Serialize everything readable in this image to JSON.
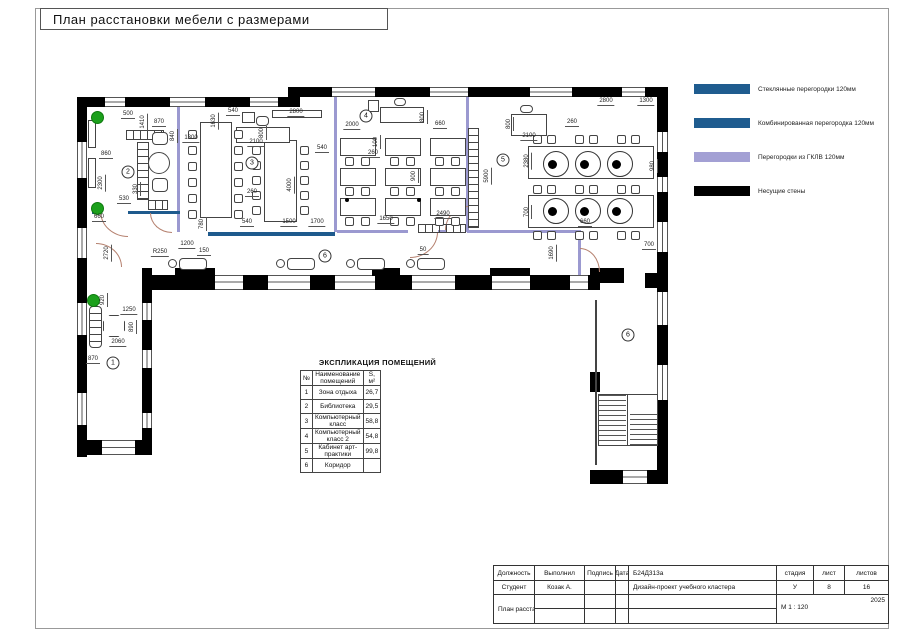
{
  "sheet": {
    "title": "План расстановки мебели с размерами"
  },
  "legend": {
    "items": [
      {
        "name": "glass-partition",
        "label": "Стеклянные перегородки  120мм",
        "color": "#1F5C8F"
      },
      {
        "name": "combined-partition",
        "label": "Комбинированная перегородка 120мм",
        "color": "#1F5C8F"
      },
      {
        "name": "gklv-partition",
        "label": "Перегородки из ГКЛВ 120мм",
        "color": "#A3A0D4"
      },
      {
        "name": "bearing-walls",
        "label": "Несущие стены",
        "color": "#000000"
      }
    ]
  },
  "explication": {
    "title": "ЭКСПЛИКАЦИЯ ПОМЕЩЕНИЙ",
    "headers": [
      "№",
      "Наименование помещений",
      "S, м²"
    ],
    "rows": [
      {
        "num": "1",
        "name": "Зона отдыха",
        "area": "26,7"
      },
      {
        "num": "2",
        "name": "Библиотека",
        "area": "29,5"
      },
      {
        "num": "3",
        "name": "Компьютерный класс",
        "area": "58,8"
      },
      {
        "num": "4",
        "name": "Компьютерный класс 2",
        "area": "54,8"
      },
      {
        "num": "5",
        "name": "Кабинет арт-практики",
        "area": "99,8"
      },
      {
        "num": "6",
        "name": "Коридор",
        "area": ""
      }
    ]
  },
  "titleblock": {
    "col_role": "Должность",
    "col_done": "Выполнил",
    "col_sign": "Подпись",
    "col_date": "Дата",
    "role": "Студент",
    "name": "Козак А.",
    "code": "Б24Д313а",
    "project": "Дизайн-проект учебного кластера",
    "sheet_title": "План расстановки мебели с размерами",
    "stage_label": "стадия",
    "sheet_label": "лист",
    "sheets_label": "листов",
    "stage": "У",
    "sheet_num": "8",
    "sheets_total": "16",
    "year": "2025",
    "scale": "М 1 : 120"
  },
  "plan": {
    "rooms": [
      {
        "n": "1",
        "x": 113,
        "y": 363
      },
      {
        "n": "2",
        "x": 128,
        "y": 172
      },
      {
        "n": "3",
        "x": 252,
        "y": 163
      },
      {
        "n": "4",
        "x": 366,
        "y": 116
      },
      {
        "n": "5",
        "x": 503,
        "y": 160
      },
      {
        "n": "6",
        "x": 325,
        "y": 256
      },
      {
        "n": "6",
        "x": 628,
        "y": 335
      }
    ],
    "dimensions": [
      {
        "t": "500",
        "x": 128,
        "y": 119
      },
      {
        "t": "1410",
        "x": 144,
        "y": 122,
        "v": 1
      },
      {
        "t": "870",
        "x": 159,
        "y": 127
      },
      {
        "t": "840",
        "x": 174,
        "y": 136,
        "v": 1
      },
      {
        "t": "860",
        "x": 106,
        "y": 159
      },
      {
        "t": "2300",
        "x": 102,
        "y": 183,
        "v": 1
      },
      {
        "t": "330",
        "x": 137,
        "y": 189,
        "v": 1
      },
      {
        "t": "530",
        "x": 124,
        "y": 204
      },
      {
        "t": "660",
        "x": 99,
        "y": 222
      },
      {
        "t": "1300",
        "x": 191,
        "y": 143
      },
      {
        "t": "1630",
        "x": 215,
        "y": 121,
        "v": 1
      },
      {
        "t": "540",
        "x": 233,
        "y": 116
      },
      {
        "t": "2100",
        "x": 256,
        "y": 147
      },
      {
        "t": "800",
        "x": 263,
        "y": 133,
        "v": 1
      },
      {
        "t": "2800",
        "x": 296,
        "y": 117
      },
      {
        "t": "540",
        "x": 322,
        "y": 153
      },
      {
        "t": "260",
        "x": 252,
        "y": 197
      },
      {
        "t": "4000",
        "x": 291,
        "y": 185,
        "v": 1
      },
      {
        "t": "780",
        "x": 203,
        "y": 224,
        "v": 1
      },
      {
        "t": "540",
        "x": 247,
        "y": 227
      },
      {
        "t": "1500",
        "x": 289,
        "y": 227
      },
      {
        "t": "1700",
        "x": 317,
        "y": 227
      },
      {
        "t": "2000",
        "x": 352,
        "y": 130
      },
      {
        "t": "660",
        "x": 440,
        "y": 129
      },
      {
        "t": "100",
        "x": 377,
        "y": 142,
        "v": 1
      },
      {
        "t": "260",
        "x": 373,
        "y": 158
      },
      {
        "t": "800",
        "x": 424,
        "y": 117,
        "v": 1
      },
      {
        "t": "900",
        "x": 415,
        "y": 176,
        "v": 1
      },
      {
        "t": "1650",
        "x": 386,
        "y": 224
      },
      {
        "t": "2490",
        "x": 443,
        "y": 219
      },
      {
        "t": "5900",
        "x": 488,
        "y": 176,
        "v": 1
      },
      {
        "t": "2800",
        "x": 606,
        "y": 106
      },
      {
        "t": "1300",
        "x": 646,
        "y": 106
      },
      {
        "t": "800",
        "x": 510,
        "y": 124,
        "v": 1
      },
      {
        "t": "2100",
        "x": 529,
        "y": 141
      },
      {
        "t": "260",
        "x": 572,
        "y": 127
      },
      {
        "t": "2380",
        "x": 528,
        "y": 161,
        "v": 1
      },
      {
        "t": "980",
        "x": 654,
        "y": 166,
        "v": 1
      },
      {
        "t": "700",
        "x": 528,
        "y": 212,
        "v": 1
      },
      {
        "t": "660",
        "x": 585,
        "y": 227
      },
      {
        "t": "1690",
        "x": 553,
        "y": 253,
        "v": 1
      },
      {
        "t": "700",
        "x": 649,
        "y": 250
      },
      {
        "t": "R250",
        "x": 160,
        "y": 257
      },
      {
        "t": "1200",
        "x": 187,
        "y": 249
      },
      {
        "t": "150",
        "x": 204,
        "y": 256
      },
      {
        "t": "50",
        "x": 423,
        "y": 255
      },
      {
        "t": "2720",
        "x": 108,
        "y": 253,
        "v": 1
      },
      {
        "t": "920",
        "x": 104,
        "y": 300,
        "v": 1
      },
      {
        "t": "1250",
        "x": 129,
        "y": 315
      },
      {
        "t": "890",
        "x": 133,
        "y": 327,
        "v": 1
      },
      {
        "t": "2060",
        "x": 118,
        "y": 347
      },
      {
        "t": "870",
        "x": 93,
        "y": 364
      }
    ]
  }
}
